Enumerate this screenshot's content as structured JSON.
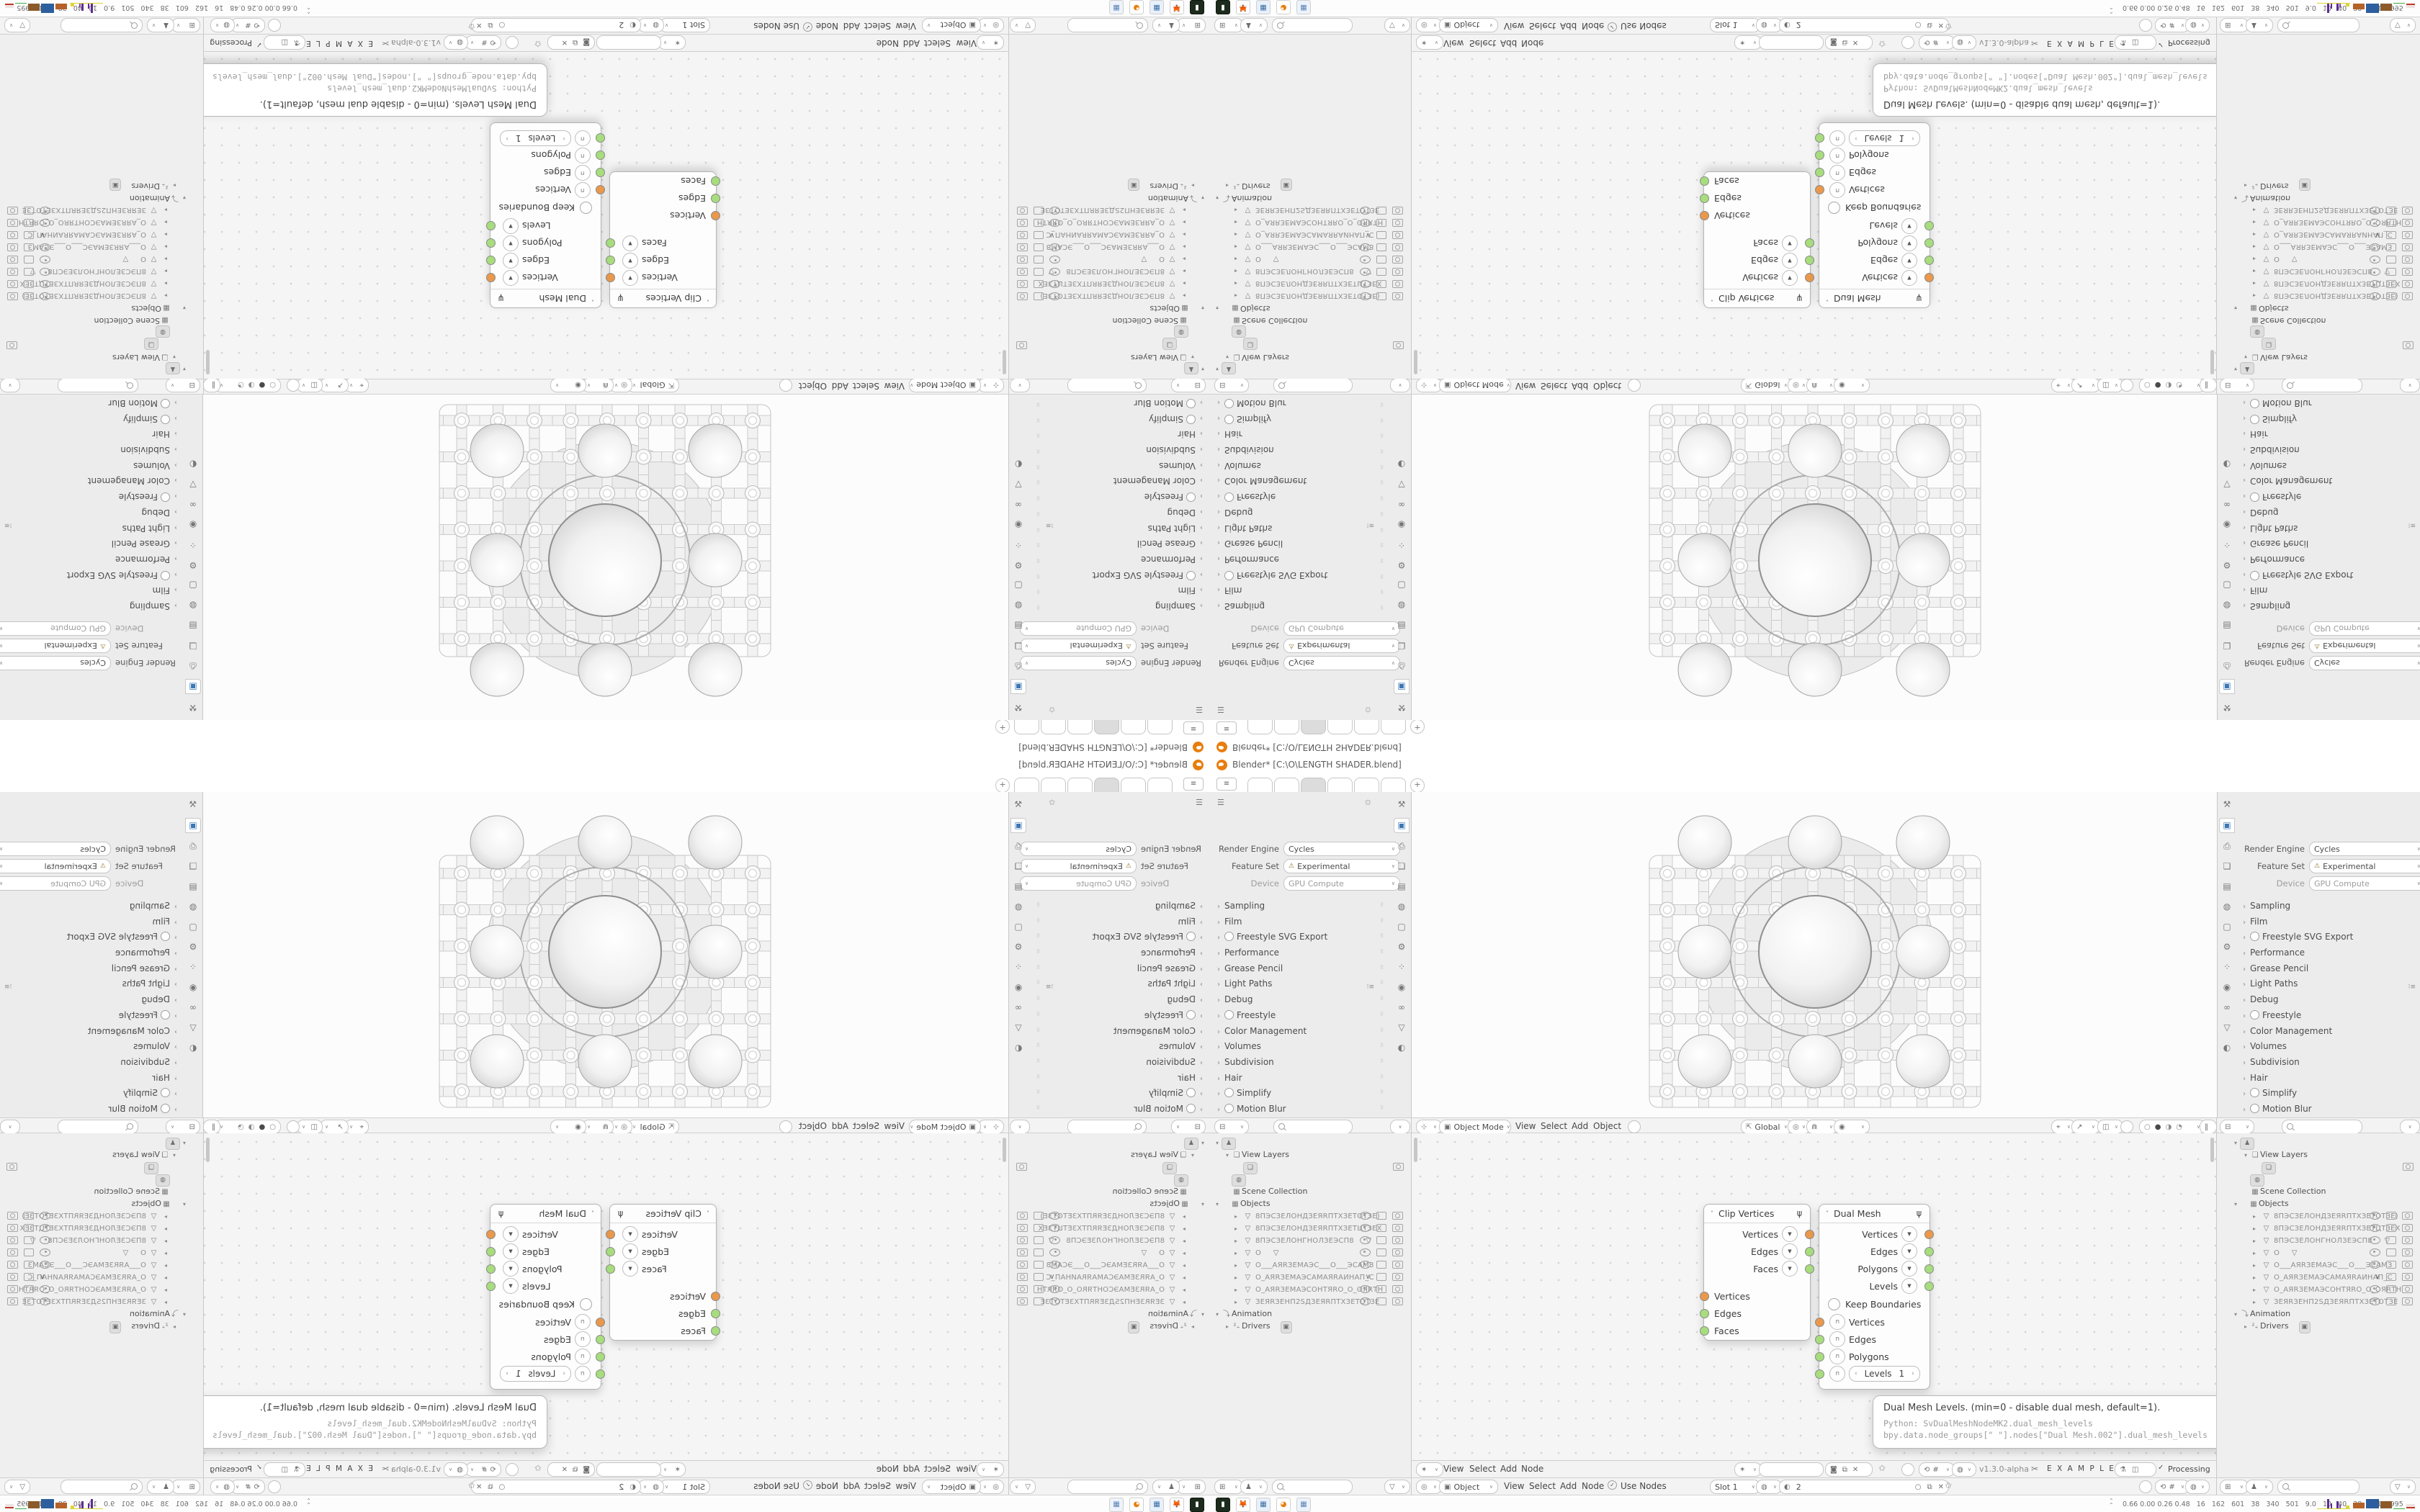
{
  "window": {
    "title": "Blender* [C:\\O\\LENGTH SHADER.blend]",
    "tab_count": 6,
    "add_tab_label": "+"
  },
  "props": {
    "render_engine_label": "Render Engine",
    "render_engine_value": "Cycles",
    "feature_set_label": "Feature Set",
    "feature_set_value": "Experimental",
    "device_label": "Device",
    "device_value": "GPU Compute",
    "sections": [
      {
        "label": "Sampling"
      },
      {
        "label": "Film"
      },
      {
        "label": "Freestyle SVG Export",
        "toggle": true
      },
      {
        "label": "Performance"
      },
      {
        "label": "Grease Pencil"
      },
      {
        "label": "Light Paths",
        "preset": true
      },
      {
        "label": "Debug"
      },
      {
        "label": "Freestyle",
        "toggle": true
      },
      {
        "label": "Color Management"
      },
      {
        "label": "Volumes"
      },
      {
        "label": "Subdivision"
      },
      {
        "label": "Hair"
      },
      {
        "label": "Simplify",
        "toggle": true
      },
      {
        "label": "Motion Blur",
        "toggle": true
      },
      {
        "label": "Bake"
      }
    ],
    "tab_icon_names": [
      "tool-icon",
      "render-icon",
      "output-icon",
      "view-layer-icon",
      "scene-icon",
      "world-icon",
      "object-icon",
      "modifiers-icon",
      "particles-icon",
      "physics-icon",
      "constraints-icon",
      "object-data-icon",
      "material-icon"
    ]
  },
  "viewport_header": {
    "mode_value": "Object Mode",
    "menus": [
      "View",
      "Select",
      "Add",
      "Object"
    ],
    "orientation_value": "Global"
  },
  "outliner": {
    "view_layers_label": "View Layers",
    "scene_collection_label": "Scene Collection",
    "objects_label": "Objects",
    "animation_label": "Animation",
    "drivers_label": "Drivers",
    "objects": [
      {
        "name": "8ПЭСЗЕЛОНДЗЕЯRПТХЗЕТОТЗЕ)",
        "eye": true,
        "mon": false,
        "cam": false
      },
      {
        "name": "8ПЭСЗЕЛОНДЗЕЯRПТХЗЕТЦТЗЕХ",
        "eye": true,
        "mon": false,
        "cam": false
      },
      {
        "name": "8ПЭСЗЕЛОНГНОЛЗЕЭСП8",
        "funnel": true,
        "eye": true,
        "mon": false,
        "cam": false
      },
      {
        "name": "O",
        "funnel": true,
        "selected": true,
        "eye": true,
        "mon": true,
        "cam": true
      },
      {
        "name": "O___АЯRЗЕМАЭС___O___ЭСАМЗ",
        "link": true,
        "eye": true,
        "mon": false,
        "cam": false
      },
      {
        "name": "O_АЯRЗЕМАЭСАМАЯRАИНАП_С",
        "link": true,
        "vee": true,
        "mon": false,
        "cam": false
      },
      {
        "name": "O_АЯRЗЕМАЭСОНТЯRO_O_ОЯRТН",
        "link": true,
        "eye": true,
        "mon": false,
        "cam": false
      },
      {
        "name": "ЗЕЯRЗЕНП2SДЗЕЯRПТХЗЕТОТЗЕ",
        "eye": true,
        "mon": false,
        "cam": false
      }
    ]
  },
  "node_editor": {
    "header": {
      "menus": [
        "View",
        "Select",
        "Add",
        "Node"
      ],
      "version": "v1.3.0-alpha",
      "examples_label": "E X A M P L E S",
      "processing_label": "Processing"
    },
    "nodes": {
      "clip": {
        "title": "Clip Vertices",
        "outputs": [
          {
            "name": "Vertices",
            "color": "#e9984c"
          },
          {
            "name": "Edges",
            "color": "#a7dd7d"
          },
          {
            "name": "Faces",
            "color": "#a7dd7d"
          }
        ],
        "inputs": [
          {
            "name": "Vertices",
            "color": "#e9984c"
          },
          {
            "name": "Edges",
            "color": "#a7dd7d"
          },
          {
            "name": "Faces",
            "color": "#a7dd7d"
          }
        ]
      },
      "dual": {
        "title": "Dual Mesh",
        "outputs": [
          {
            "name": "Vertices",
            "color": "#e9984c"
          },
          {
            "name": "Edges",
            "color": "#a7dd7d"
          },
          {
            "name": "Polygons",
            "color": "#a7dd7d"
          },
          {
            "name": "Levels",
            "color": "#a7dd7d"
          }
        ],
        "keep_boundaries_label": "Keep Boundaries",
        "inputs": [
          {
            "name": "Vertices",
            "color": "#e9984c"
          },
          {
            "name": "Edges",
            "color": "#a7dd7d"
          },
          {
            "name": "Polygons",
            "color": "#a7dd7d"
          }
        ],
        "levels_label": "Levels",
        "levels_value": "1"
      }
    },
    "tooltip": {
      "line1": "Dual Mesh Levels. (min=0 - disable dual mesh, default=1).",
      "line2": "Python: SvDualMeshNodeMK2.dual_mesh_levels",
      "line3": "bpy.data.node_groups[\" \"].nodes[\"Dual Mesh.002\"].dual_mesh_levels"
    }
  },
  "shader_header": {
    "type_value": "Object",
    "menus": [
      "View",
      "Select",
      "Add",
      "Node"
    ],
    "use_nodes_label": "Use Nodes",
    "slot_value": "Slot 1",
    "material_value": "2"
  },
  "status": {
    "stats": "0.66 0.00 0.26 0.48   16   162   601   38   340   501   9.0   10   40   38   57106995"
  },
  "taskbar": {
    "app_icon_names": [
      "terminal-icon",
      "firefox-icon",
      "calculator-icon",
      "blender-icon",
      "calculator2-icon"
    ]
  },
  "colors": {
    "socket_orange": "#e9984c",
    "socket_green": "#a7dd7d",
    "accent_blue": "#3c78b4"
  }
}
